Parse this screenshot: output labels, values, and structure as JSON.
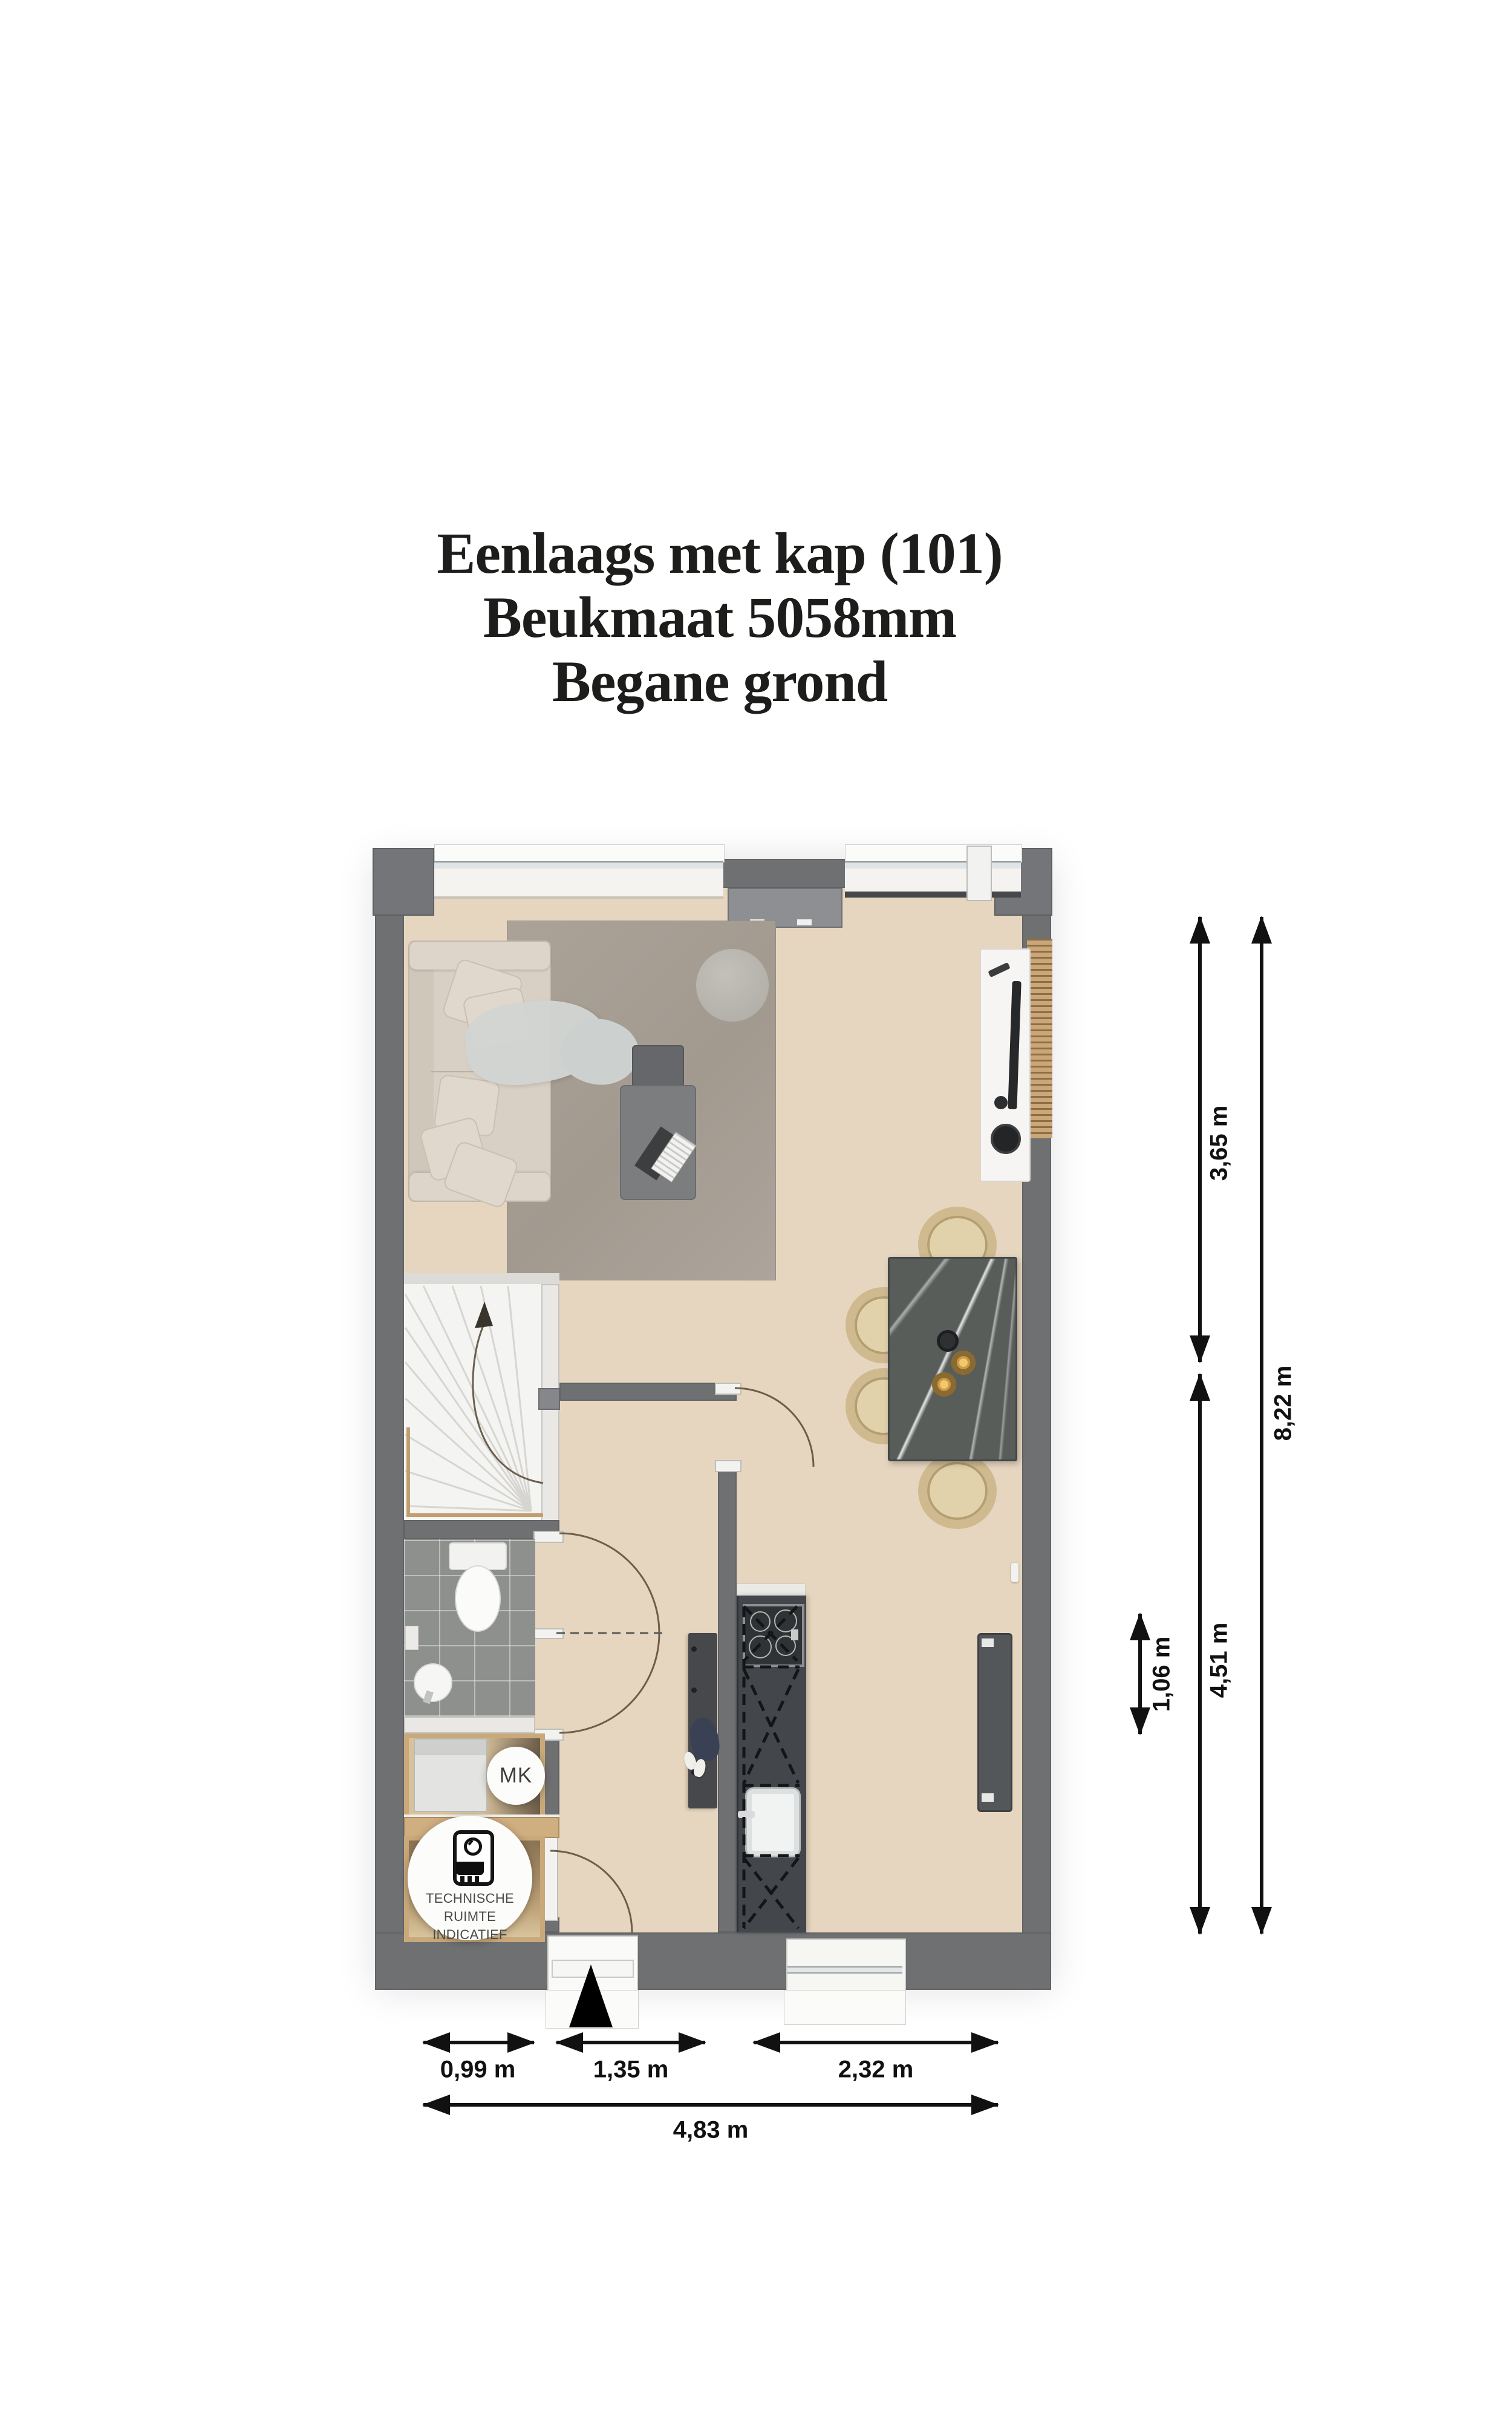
{
  "title": {
    "line1": "Eenlaags met kap (101)",
    "line2": "Beukmaat 5058mm",
    "line3": "Begane grond"
  },
  "plan": {
    "labels": {
      "meter_cupboard": "MK",
      "technical_1": "TECHNISCHE RUIMTE",
      "technical_2": "INDICATIEF"
    },
    "dimensions": {
      "vertical": [
        {
          "label": "3,65 m"
        },
        {
          "label": "4,51 m"
        },
        {
          "label": "8,22 m"
        },
        {
          "label": "1,06 m"
        }
      ],
      "horizontal": [
        {
          "label": "0,99 m"
        },
        {
          "label": "1,35 m"
        },
        {
          "label": "2,32 m"
        },
        {
          "label": "4,83 m"
        }
      ]
    },
    "icons": {
      "entry_arrow": "solid black triangle pointing up at entrance",
      "boiler": "boiler unit pictogram inside technical-room badge",
      "stair_direction": "curved arrow up the winder staircase"
    },
    "colors": {
      "wall": "#6f7072",
      "floor": "#e7d6bf",
      "rug": "#a9a099",
      "sofa": "#d8d0c4",
      "kitchen_unit": "#43464a",
      "dining_table": "#585d5a",
      "wood": "#cfae7e",
      "tile_floor": "#8d908c",
      "stairs": "#f4f4f2",
      "dimension": "#111111",
      "door_arc": "#6e5e48"
    }
  }
}
